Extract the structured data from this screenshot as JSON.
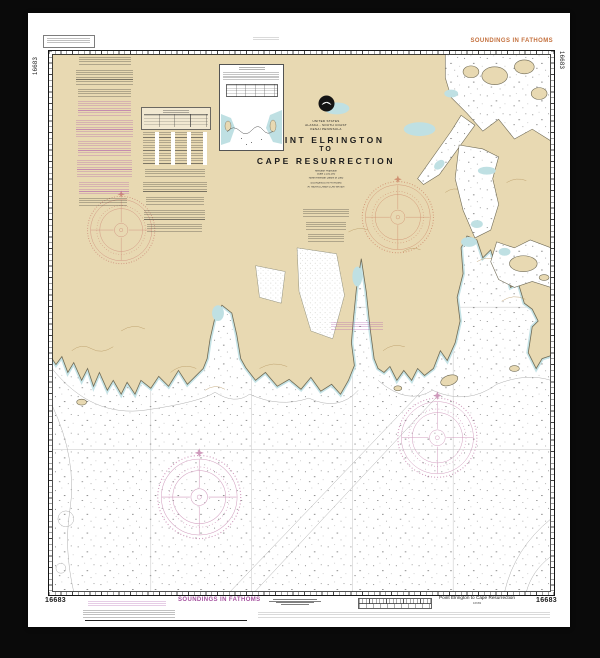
{
  "artwork": {
    "kind": "NOAA nautical chart framed print",
    "chart_number": "16683"
  },
  "margins": {
    "top_right_label": "SOUNDINGS IN FATHOMS",
    "bottom_center_label": "SOUNDINGS IN FATHOMS",
    "corner_number": "16683",
    "bottom_right_title": "Point Elrington to Cape Resurrection"
  },
  "title_block": {
    "country": "UNITED STATES",
    "region": "ALASKA - SOUTH COAST",
    "subregion": "KENAI PENINSULA",
    "title_line1": "POINT ELRINGTON",
    "title_line2": "TO",
    "title_line3": "CAPE RESURRECTION",
    "note_line1": "Mercator Projection",
    "note_line2": "Scale 1:100,000",
    "note_line3": "North American Datum of 1983",
    "note_line4": "SOUNDINGS IN FATHOMS",
    "note_line5": "AT MEAN LOWER LOW WATER"
  },
  "colors": {
    "frame": "#0a0a0a",
    "paper": "#ffffff",
    "land": "#e8d9b2",
    "shallow_water": "#bfe0e3",
    "label_orange": "#c4703d",
    "label_magenta": "#a653a0",
    "compass_rose_land": "#c98072",
    "compass_rose_water": "#c583ad"
  }
}
